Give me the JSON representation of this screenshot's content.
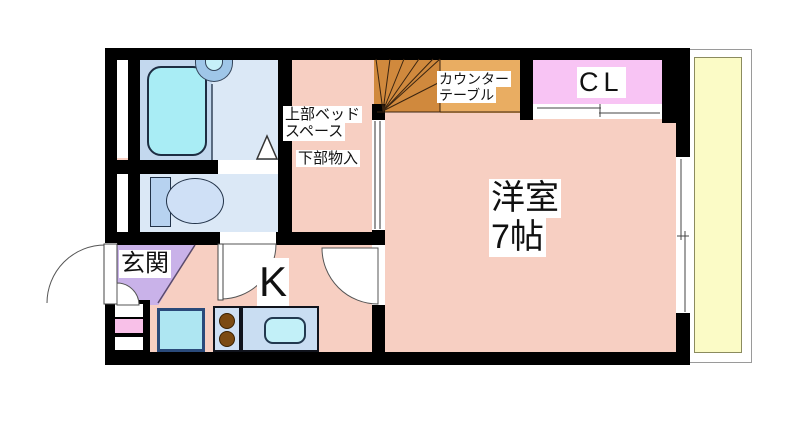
{
  "plan": {
    "type": "japanese-apartment-floor-plan",
    "rooms": {
      "genkan": {
        "label": "玄関"
      },
      "kitchen": {
        "label": "K"
      },
      "western_room": {
        "label": "洋室",
        "size_label": "7帖"
      },
      "closet": {
        "label": "CL"
      },
      "bed_space": {
        "line1": "上部ベッド",
        "line2": "スペース"
      },
      "storage_under_bed": {
        "label": "下部物入"
      },
      "counter_table": {
        "line1": "カウンター",
        "line2": "テーブル"
      }
    },
    "colors": {
      "wall": "#000000",
      "room_pink": "#f7cfc2",
      "genkan_purple": "#c9b2e9",
      "closet_pink": "#f8c4f4",
      "balcony_yellow": "#fbfbc6",
      "bathroom_blue": "#dbe8f6",
      "bath_strip_blue": "#c3d8ee",
      "bathtub_cyan": "#a9edf5",
      "stairs_orange": "#d0893d",
      "counter_orange": "#e9ad62",
      "kitchen_fixture_blue": "#c9ddf2",
      "kitchen_sink_cyan": "#c2f0f8",
      "burner_brown": "#7c4a12",
      "utility_box_pink": "#f8c0e8"
    }
  }
}
